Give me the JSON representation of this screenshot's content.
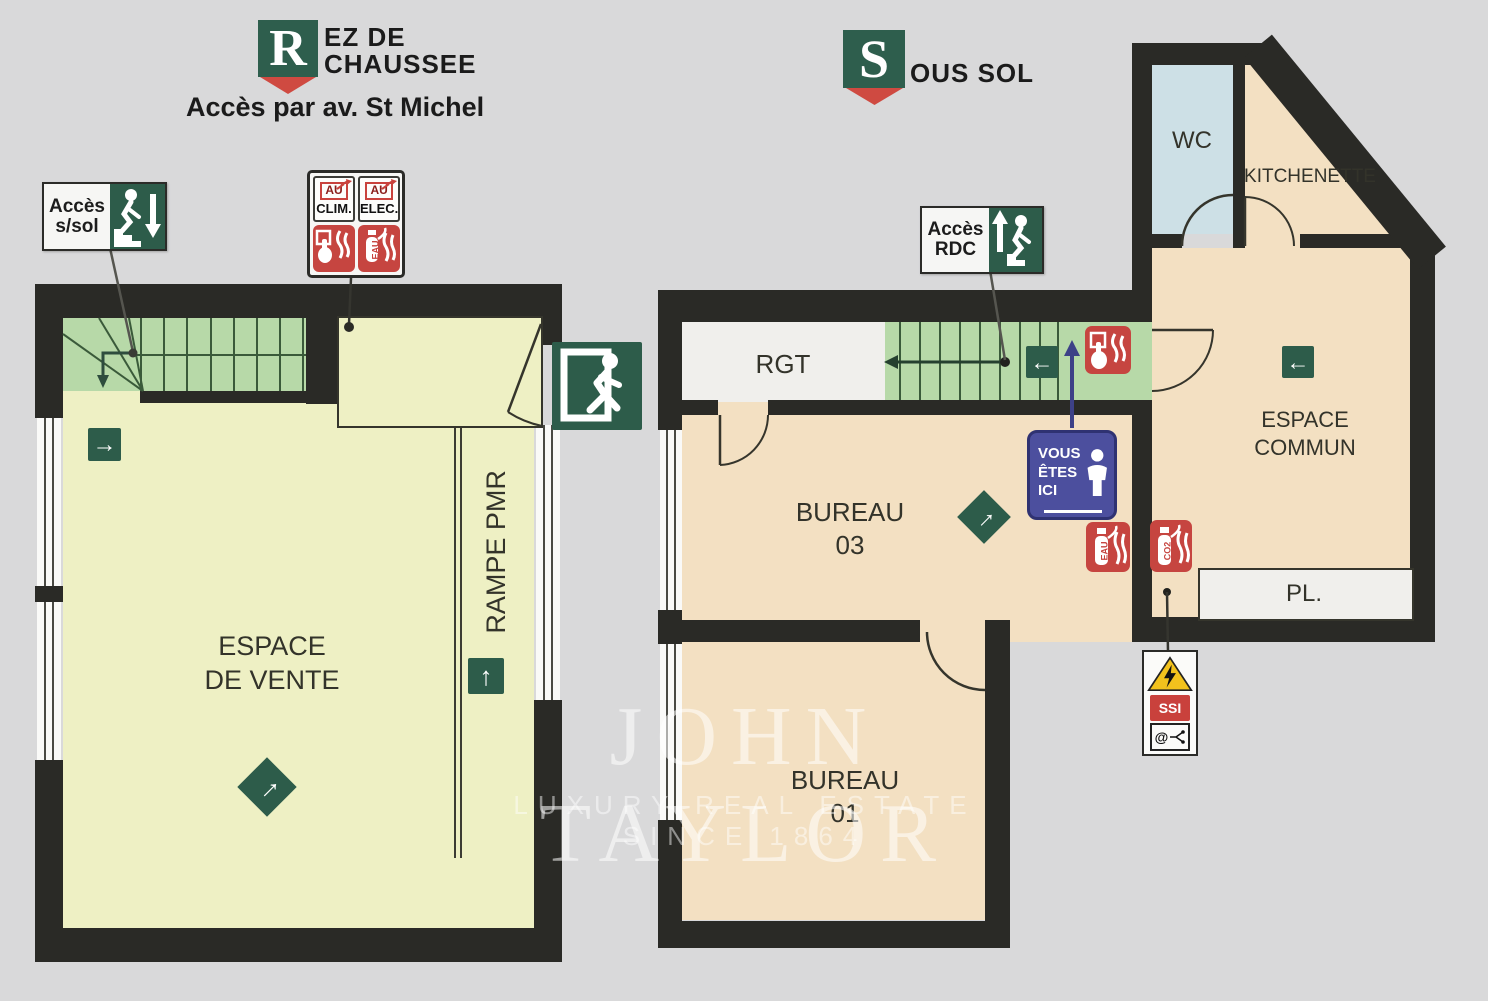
{
  "titles": {
    "ground_floor": {
      "badge_letter": "R",
      "name_line1": "EZ DE",
      "name_line2": "CHAUSSEE",
      "access_note": "Accès par av. St Michel"
    },
    "basement": {
      "badge_letter": "S",
      "name": "OUS SOL"
    }
  },
  "ground_floor": {
    "access_basement_sign": {
      "line1": "Accès",
      "line2": "s/sol"
    },
    "utilities_sign": {
      "clim_tag": "AU",
      "clim_label": "CLIM.",
      "elec_tag": "AU",
      "elec_label": "ELEC.",
      "extinguisher_label": "EAU"
    },
    "sales_area": {
      "line1": "ESPACE",
      "line2": "DE VENTE"
    },
    "ramp_label": "RAMPE PMR"
  },
  "basement": {
    "access_ground_sign": {
      "line1": "Accès",
      "line2": "RDC"
    },
    "storage_label": "RGT",
    "office3": {
      "line1": "BUREAU",
      "line2": "03"
    },
    "office1": {
      "line1": "BUREAU",
      "line2": "01"
    },
    "wc_label": "WC",
    "kitchenette_label": "KITCHENETTE",
    "common_area": {
      "line1": "ESPACE",
      "line2": "COMMUN"
    },
    "closet_label": "PL.",
    "you_are_here": {
      "line1": "VOUS",
      "line2": "ÊTES",
      "line3": "ICI"
    },
    "extinguisher_eau": "EAU",
    "extinguisher_co2": "CO2",
    "ssi_label": "SSI",
    "at_label": "@"
  },
  "icons": {
    "arrow_right": "→",
    "arrow_left": "←",
    "arrow_up": "↑",
    "arrow_ne": "→"
  },
  "watermark": {
    "brand": "JOHN TAYLOR",
    "tagline": "LUXURY REAL ESTATE SINCE 1864"
  },
  "colors": {
    "background": "#d9d9da",
    "wall": "#2a2a26",
    "ground_room": "#eef0c4",
    "stairs_green": "#b7d9a8",
    "basement_room": "#f3e0c2",
    "wc_blue": "#cde0e6",
    "white_room": "#f0efec",
    "sign_green": "#2d5c4a",
    "sign_red": "#c64540",
    "sign_blue": "#4c4f9e",
    "logo_green": "#2e5e4d",
    "logo_red": "#cf4a41"
  }
}
